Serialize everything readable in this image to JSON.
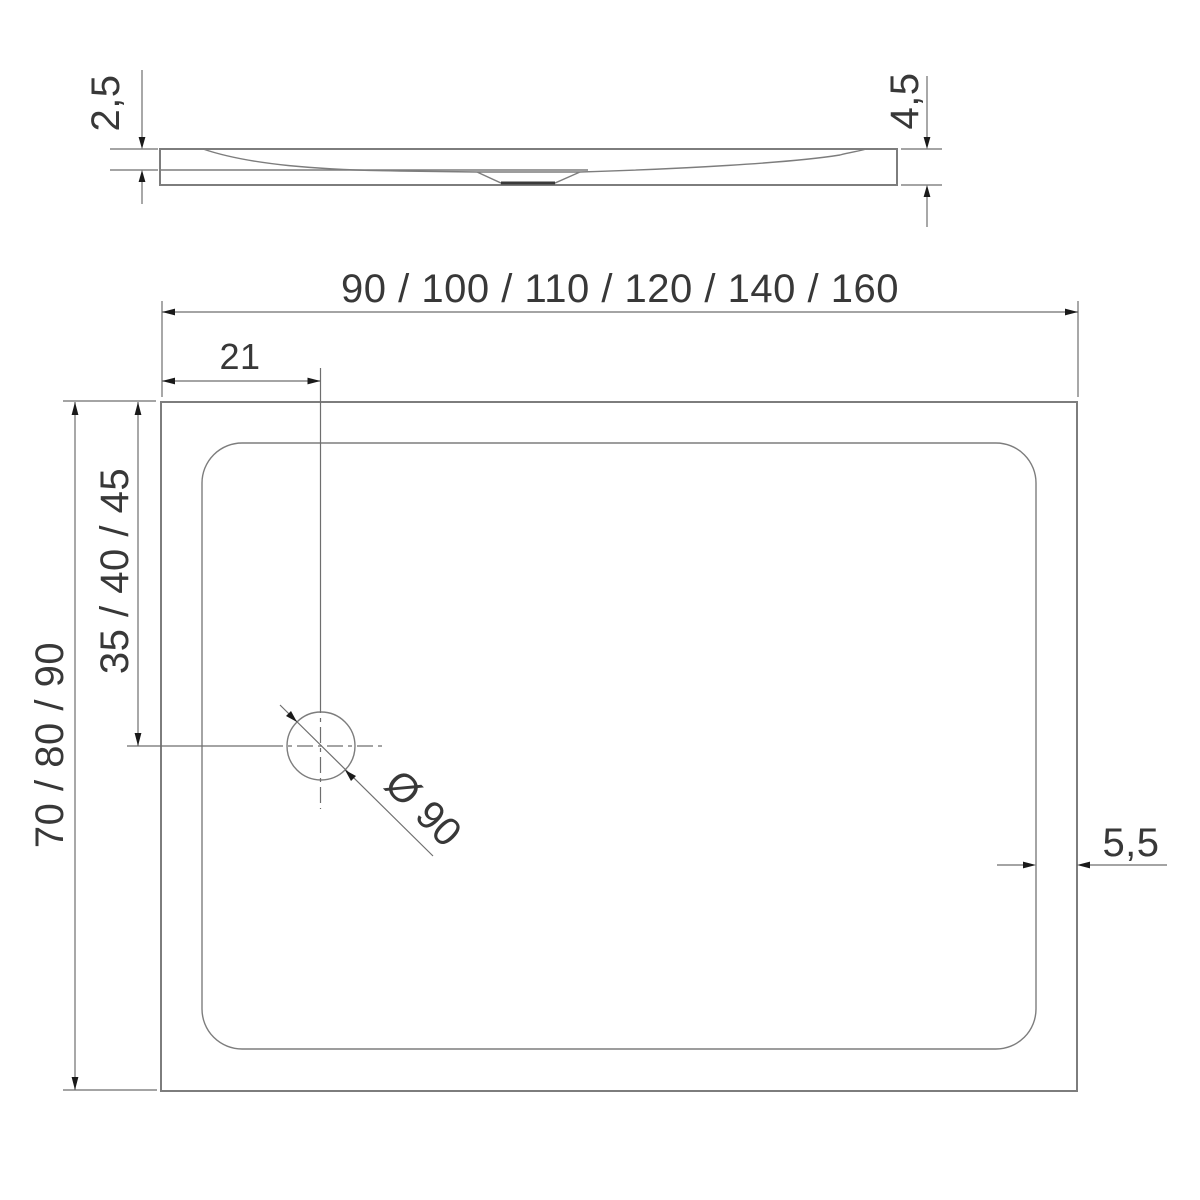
{
  "drawing": {
    "type": "technical-dimension-drawing",
    "subject": "rectangular shower tray with offset round drain, side profile and plan view",
    "background": "#ffffff",
    "line_color": "#7d7d7d",
    "dim_line_color": "#6e6e6e",
    "arrow_color": "#1a1a1a",
    "text_color": "#383838"
  },
  "side_view": {
    "rim_height": "2,5",
    "total_height": "4,5"
  },
  "plan_view": {
    "width_options": "90 / 100 / 110 / 120 / 140 / 160",
    "depth_options": "70 / 80 / 90",
    "drain_offset_from_left": "21",
    "drain_offset_options": "35 / 40 / 45",
    "drain_diameter": "Ø 90",
    "edge_width": "5,5"
  }
}
